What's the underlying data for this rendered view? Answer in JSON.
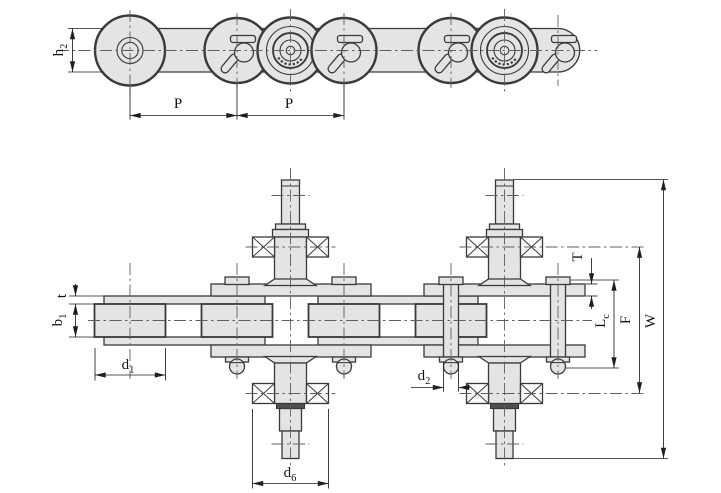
{
  "colors": {
    "part_fill": "#e4e4e4",
    "outline": "#3a3a3a",
    "dimension_line": "#1f1f1f",
    "centerline": "#5f5f5f",
    "background": "#ffffff"
  },
  "dimension_labels": {
    "h2": {
      "main": "h",
      "sub": "2"
    },
    "pitch_left": {
      "main": "P",
      "sub": ""
    },
    "pitch_right": {
      "main": "P",
      "sub": ""
    },
    "plate_thickness": {
      "main": "t",
      "sub": ""
    },
    "inner_width": {
      "main": "b",
      "sub": "1"
    },
    "roller_diameter": {
      "main": "d",
      "sub": "1"
    },
    "bearing_diameter": {
      "main": "d",
      "sub": "6"
    },
    "pin_diameter": {
      "main": "d",
      "sub": "2"
    },
    "attachment_thickness": {
      "main": "T",
      "sub": ""
    },
    "pin_length": {
      "main": "L",
      "sub": "c"
    },
    "bearing_span": {
      "main": "F",
      "sub": ""
    },
    "overall_width": {
      "main": "W",
      "sub": ""
    }
  }
}
